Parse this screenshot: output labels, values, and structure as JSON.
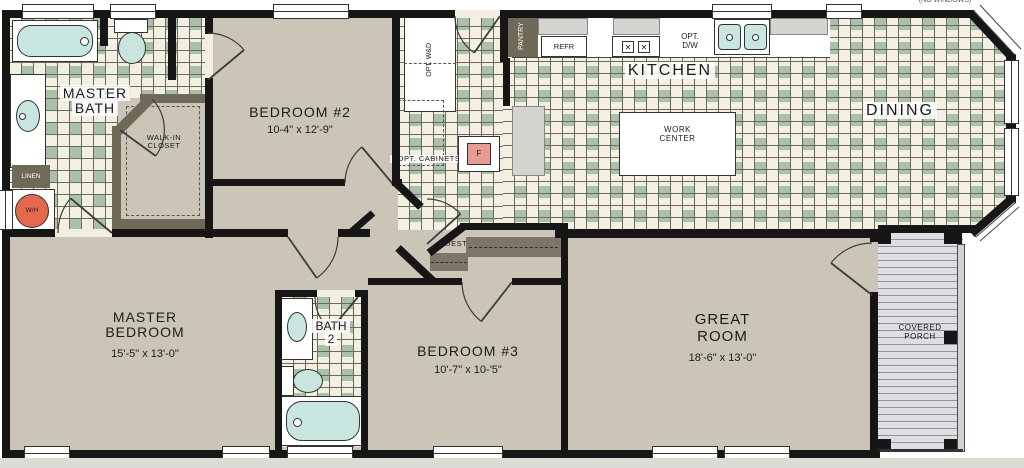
{
  "annotation": {
    "no_windows": "(NO WINDOWS)"
  },
  "rooms": {
    "master_bath": {
      "line1": "MASTER",
      "line2": "BATH"
    },
    "walk_in_closet": {
      "line1": "WALK-IN",
      "line2": "CLOSET"
    },
    "bedroom_2": {
      "name": "BEDROOM #2",
      "dims": "10-4\" x 12'-9\""
    },
    "kitchen": {
      "name": "KITCHEN"
    },
    "dining": {
      "name": "DINING"
    },
    "great_room": {
      "line1": "GREAT",
      "line2": "ROOM",
      "dims": "18'-6\" x 13'-0\""
    },
    "master_bedroom": {
      "line1": "MASTER",
      "line2": "BEDROOM",
      "dims": "15'-5\" x 13'-0\""
    },
    "bath_2": {
      "line1": "BATH",
      "line2": "2"
    },
    "bedroom_3": {
      "name": "BEDROOM #3",
      "dims": "10'-7\" x 10-'5\""
    },
    "covered_porch": {
      "line1": "COVERED",
      "line2": "PORCH"
    },
    "guest_closet": {
      "name": "GUEST"
    }
  },
  "features": {
    "linen": "LINEN",
    "water_heater": "W/H",
    "furnace": "F",
    "pantry": "PANTRY",
    "refrigerator": "REFR",
    "optional_washer_dryer": "OPT. W&D",
    "optional_cabinets": "OPT. CABINETS",
    "optional_dishwasher_line1": "OPT.",
    "optional_dishwasher_line2": "D/W",
    "work_center_line1": "WORK",
    "work_center_line2": "CENTER",
    "stove_burner_glyph": "✕"
  },
  "colors": {
    "wall": "#161616",
    "tile": "#f4f0e1",
    "tile_accent": "#abc0a9",
    "floor": "#cac5b7",
    "fixture": "#c9e5df",
    "water_heater_accent": "#e4694f",
    "furnace_accent": "#e79b92",
    "cabinet_dark": "#6f6a57",
    "porch_deck": "#dcdee2"
  }
}
